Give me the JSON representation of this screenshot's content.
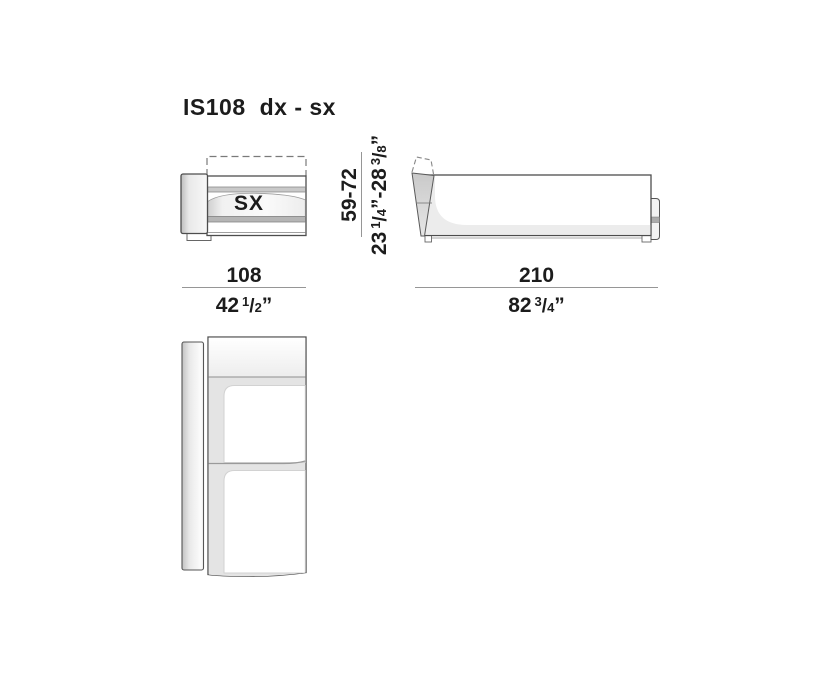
{
  "page": {
    "title_model": "IS108",
    "title_variant": "dx - sx"
  },
  "front_view": {
    "orientation_label": "SX"
  },
  "glyphs": {
    "fraction_slash": "/",
    "inch_mark": "”",
    "range_dash": "-"
  },
  "dimensions": {
    "front_width": {
      "cm": "108",
      "in_whole": "42",
      "in_num": "1",
      "in_den": "2"
    },
    "side_length": {
      "cm": "210",
      "in_whole": "82",
      "in_num": "3",
      "in_den": "4"
    },
    "height_range": {
      "cm": "59-72",
      "min_whole": "23",
      "min_num": "1",
      "min_den": "4",
      "max_whole": "28",
      "max_num": "3",
      "max_den": "8"
    }
  }
}
